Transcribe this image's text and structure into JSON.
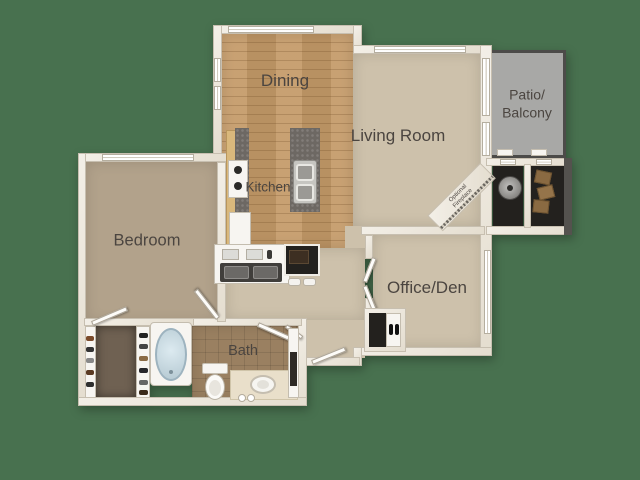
{
  "rooms": {
    "dining": {
      "label": "Dining"
    },
    "living_room": {
      "label": "Living Room"
    },
    "patio_balcony": {
      "line1": "Patio/",
      "line2": "Balcony"
    },
    "kitchen": {
      "label": "Kitchen"
    },
    "bedroom": {
      "label": "Bedroom"
    },
    "office_den": {
      "label": "Office/Den"
    },
    "bath": {
      "label": "Bath"
    },
    "optional_fireplace": {
      "line1": "Optional",
      "line2": "Fireplace"
    }
  },
  "fixtures": [
    "bathtub",
    "toilet",
    "vanity-sink",
    "kitchen-sink",
    "prep-sink",
    "stove",
    "refrigerator",
    "washer-dryer",
    "water-heater",
    "storage-boxes",
    "closet-shoes",
    "entry-door",
    "sliding-glass-door"
  ],
  "colors": {
    "bg": "#48714F",
    "wall": "#ece7de",
    "wall-edge": "#c7bfb0",
    "wood": "#c49a68",
    "carpet": "#cdc1ab",
    "carpet-dark": "#b2a28b",
    "tile": "#9a8061",
    "patio": "#a8a8a6",
    "patio-border": "#4c4b49",
    "granite": "#6d6863",
    "dark-closet": "#23211e",
    "tub": "#bfd2da",
    "label": "#4b4540"
  }
}
